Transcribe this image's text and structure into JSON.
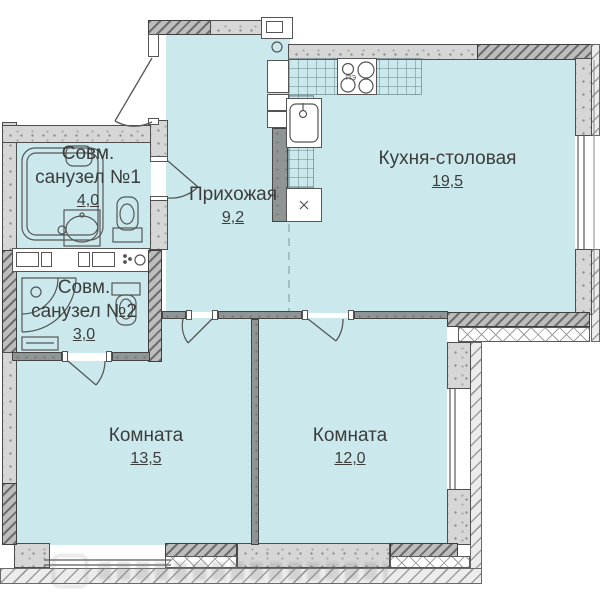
{
  "plan": {
    "bath1": {
      "line1": "Совм.",
      "line2": "санузел №1",
      "area": "4,0"
    },
    "hall": {
      "name": "Прихожая",
      "area": "9,2"
    },
    "kitchen": {
      "name": "Кухня-столовая",
      "area": "19,5"
    },
    "bath2": {
      "line1": "Совм.",
      "line2": "санузел №2",
      "area": "3,0"
    },
    "room_left": {
      "name": "Комната",
      "area": "13,5"
    },
    "room_right": {
      "name": "Комната",
      "area": "12,0"
    },
    "stove_label": "ПЭ",
    "colors": {
      "room_fill": "#cbe9ec",
      "wall_gray": "#d6d6d6",
      "line": "#4f4f4f"
    }
  }
}
